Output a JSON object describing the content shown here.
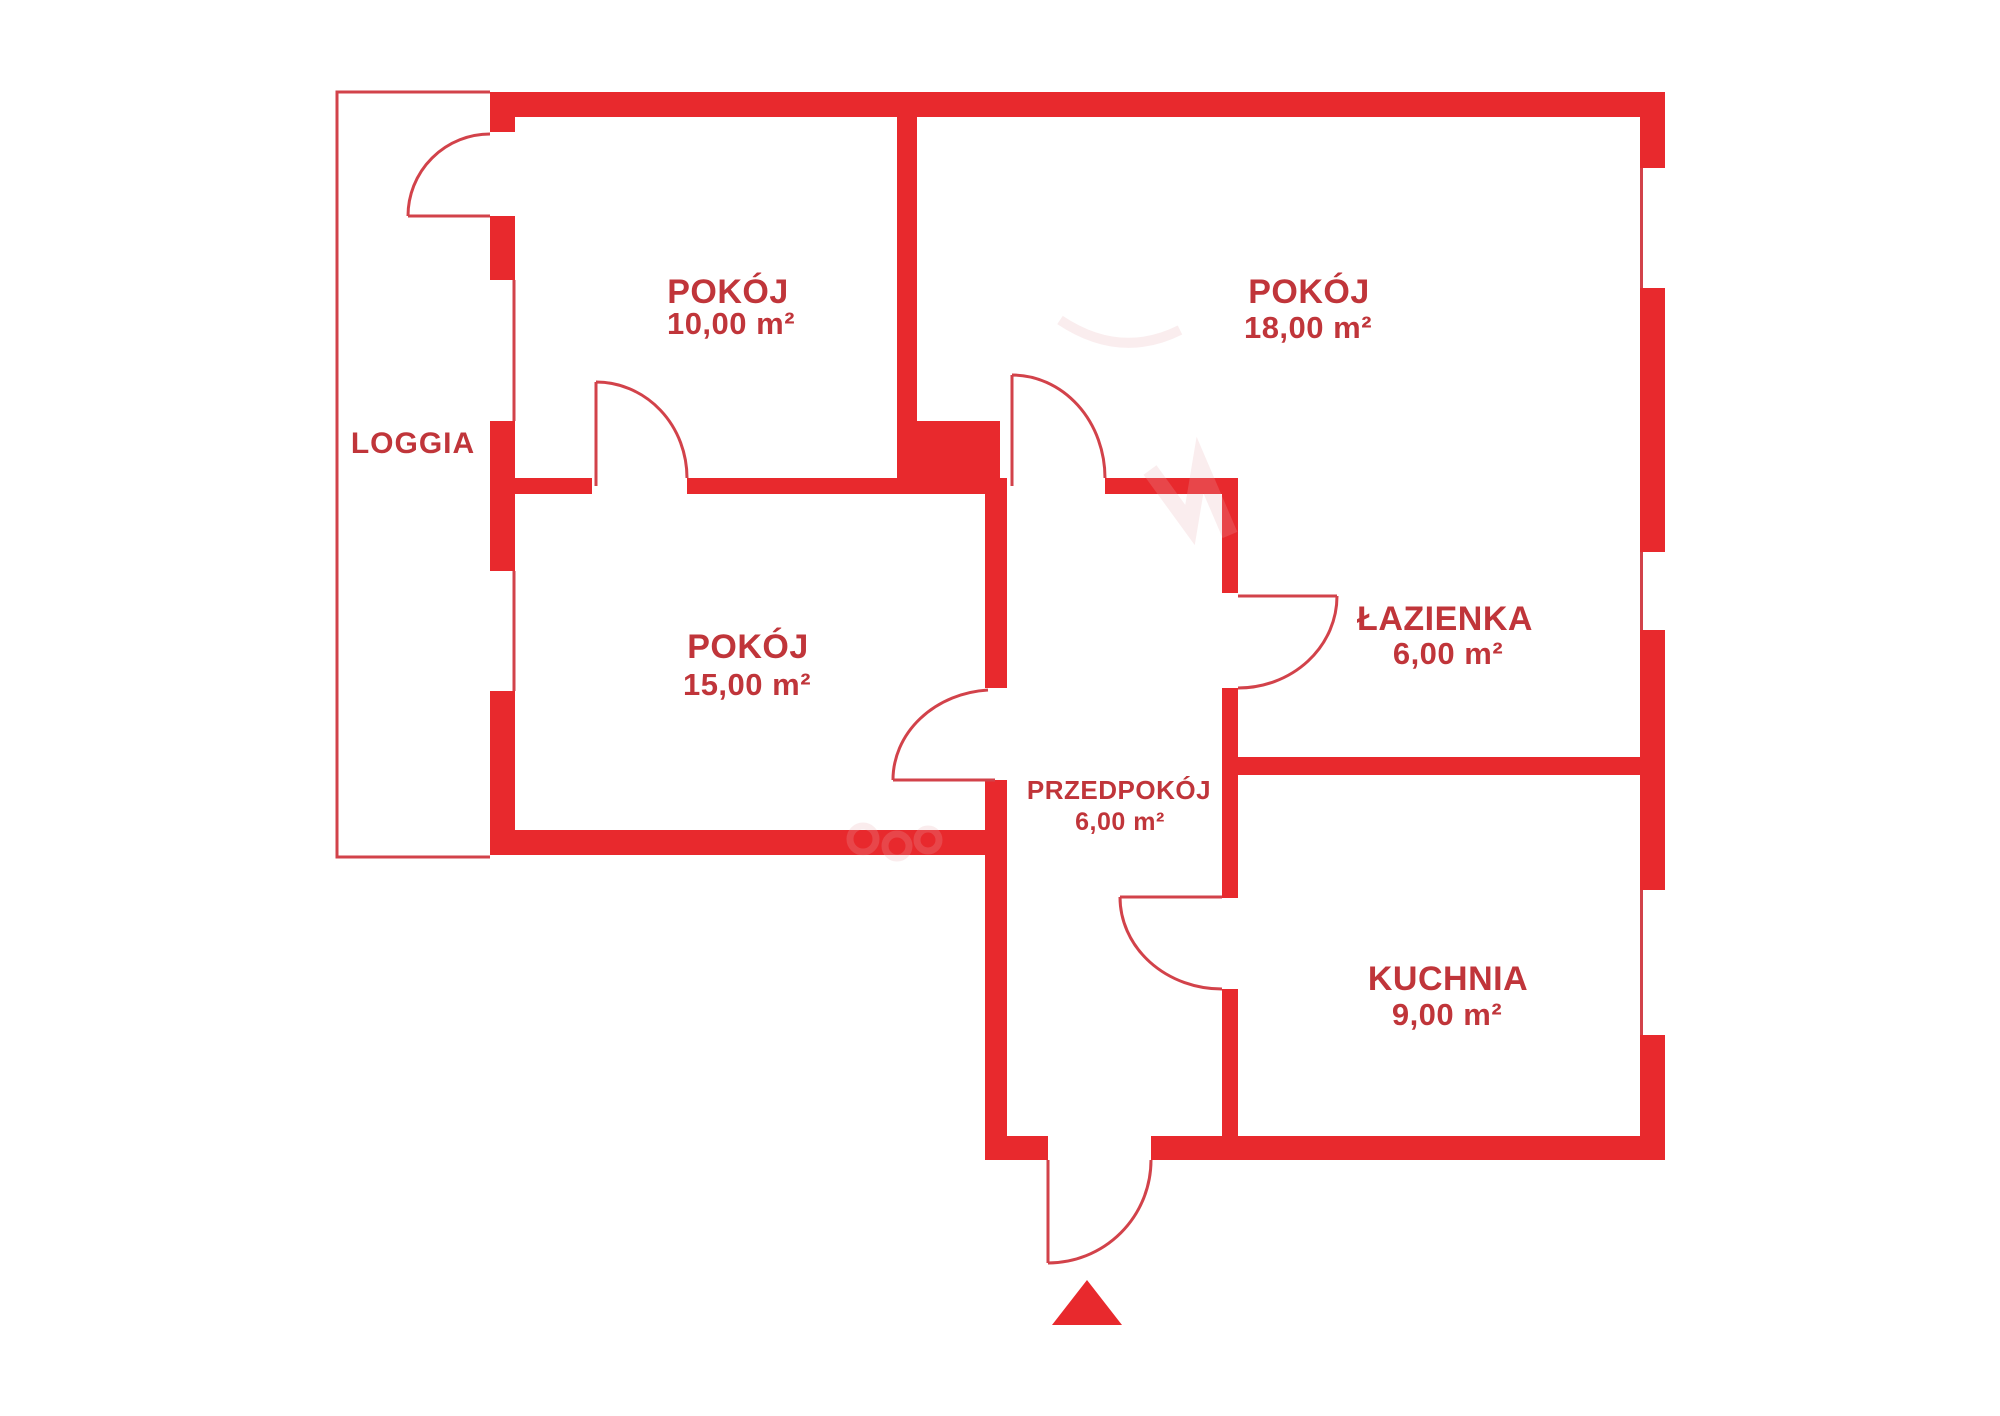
{
  "plan": {
    "type": "apartment-floor-plan",
    "colors": {
      "wall": "#e8292d",
      "text": "#c0353a",
      "line": "#d2424a",
      "watermark": "#eaacb0"
    },
    "rooms": [
      {
        "id": "loggia",
        "name": "LOGGIA",
        "area": ""
      },
      {
        "id": "pokoj-10",
        "name": "POKÓJ",
        "area": "10,00 m²"
      },
      {
        "id": "pokoj-18",
        "name": "POKÓJ",
        "area": "18,00 m²"
      },
      {
        "id": "pokoj-15",
        "name": "POKÓJ",
        "area": "15,00 m²"
      },
      {
        "id": "lazienka",
        "name": "ŁAZIENKA",
        "area": "6,00 m²"
      },
      {
        "id": "przedpokoj",
        "name": "PRZEDPOKÓJ",
        "area": "6,00 m²"
      },
      {
        "id": "kuchnia",
        "name": "KUCHNIA",
        "area": "9,00 m²"
      }
    ],
    "markers": [
      {
        "id": "entrance-arrow",
        "meaning": "main entrance direction"
      }
    ]
  }
}
